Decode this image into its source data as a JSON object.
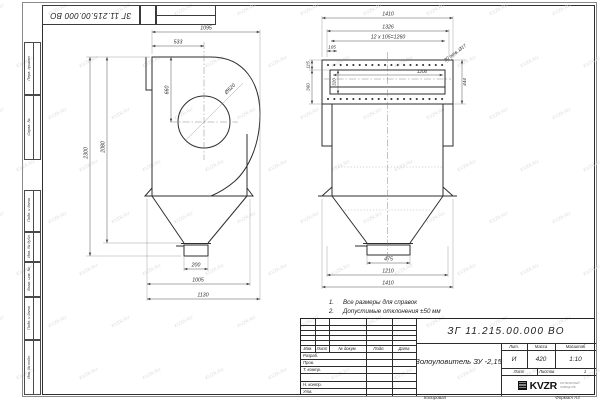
{
  "sheet": {
    "watermark": "KVZR.RU",
    "corner_stamp": "ЗГ 11.215.00.000  ВО",
    "side_labels": [
      "Перв. примен.",
      "Справ. №",
      "Подп. и дата",
      "Инв. № дубл.",
      "Взам. инв. №",
      "Подп. и дата",
      "Инв. № подл."
    ],
    "copied_label": "Копировал",
    "format_label": "Формат А3"
  },
  "views": {
    "left": {
      "dims": {
        "w1095": "1095",
        "w533": "533",
        "h660": "660",
        "dia": "Ø520",
        "h2300": "2300",
        "h2080": "2080",
        "w200": "200",
        "w1005": "1005",
        "w1130": "1130"
      }
    },
    "right": {
      "dims": {
        "top1410": "1410",
        "w1326": "1326",
        "pitch": "12 х 105=1260",
        "e105": "105",
        "holes": "30 отв. Ø17",
        "v115": "115",
        "v360": "360",
        "v320": "320",
        "w1200": "1200",
        "h444": "444",
        "w475": "475",
        "w1210": "1210",
        "bot1410": "1410"
      }
    }
  },
  "notes": {
    "items": [
      {
        "num": "1.",
        "text": "Все размеры для справок"
      },
      {
        "num": "2.",
        "text": "Допустимые отклонения  ±50 мм"
      }
    ]
  },
  "title_block": {
    "doc_number": "ЗГ 11.215.00.000  ВО",
    "part_name": "Золоуловитель  ЗУ -2,15",
    "cols": {
      "izm": "Изм.",
      "list": "Лист",
      "doc": "№ докум.",
      "podp": "Подп.",
      "data": "Дата"
    },
    "rows": {
      "razrab": "Разраб.",
      "prov": "Пров.",
      "tkontr": "Т. контр.",
      "nkontr": "Н. контр.",
      "utv": "Утв."
    },
    "lit": {
      "header": "Лит.",
      "value": "И"
    },
    "mass": {
      "header": "Масса",
      "value": "420"
    },
    "scale": {
      "header": "Масштаб",
      "value": "1:10"
    },
    "sheet_row": {
      "list_label": "Лист",
      "listov_label": "Листов",
      "listov_value": "1"
    },
    "logo": {
      "text": "KVZR",
      "sub1": "КОТЕЛЬНЫЙ",
      "sub2": "ЗАВОД РФ"
    }
  }
}
